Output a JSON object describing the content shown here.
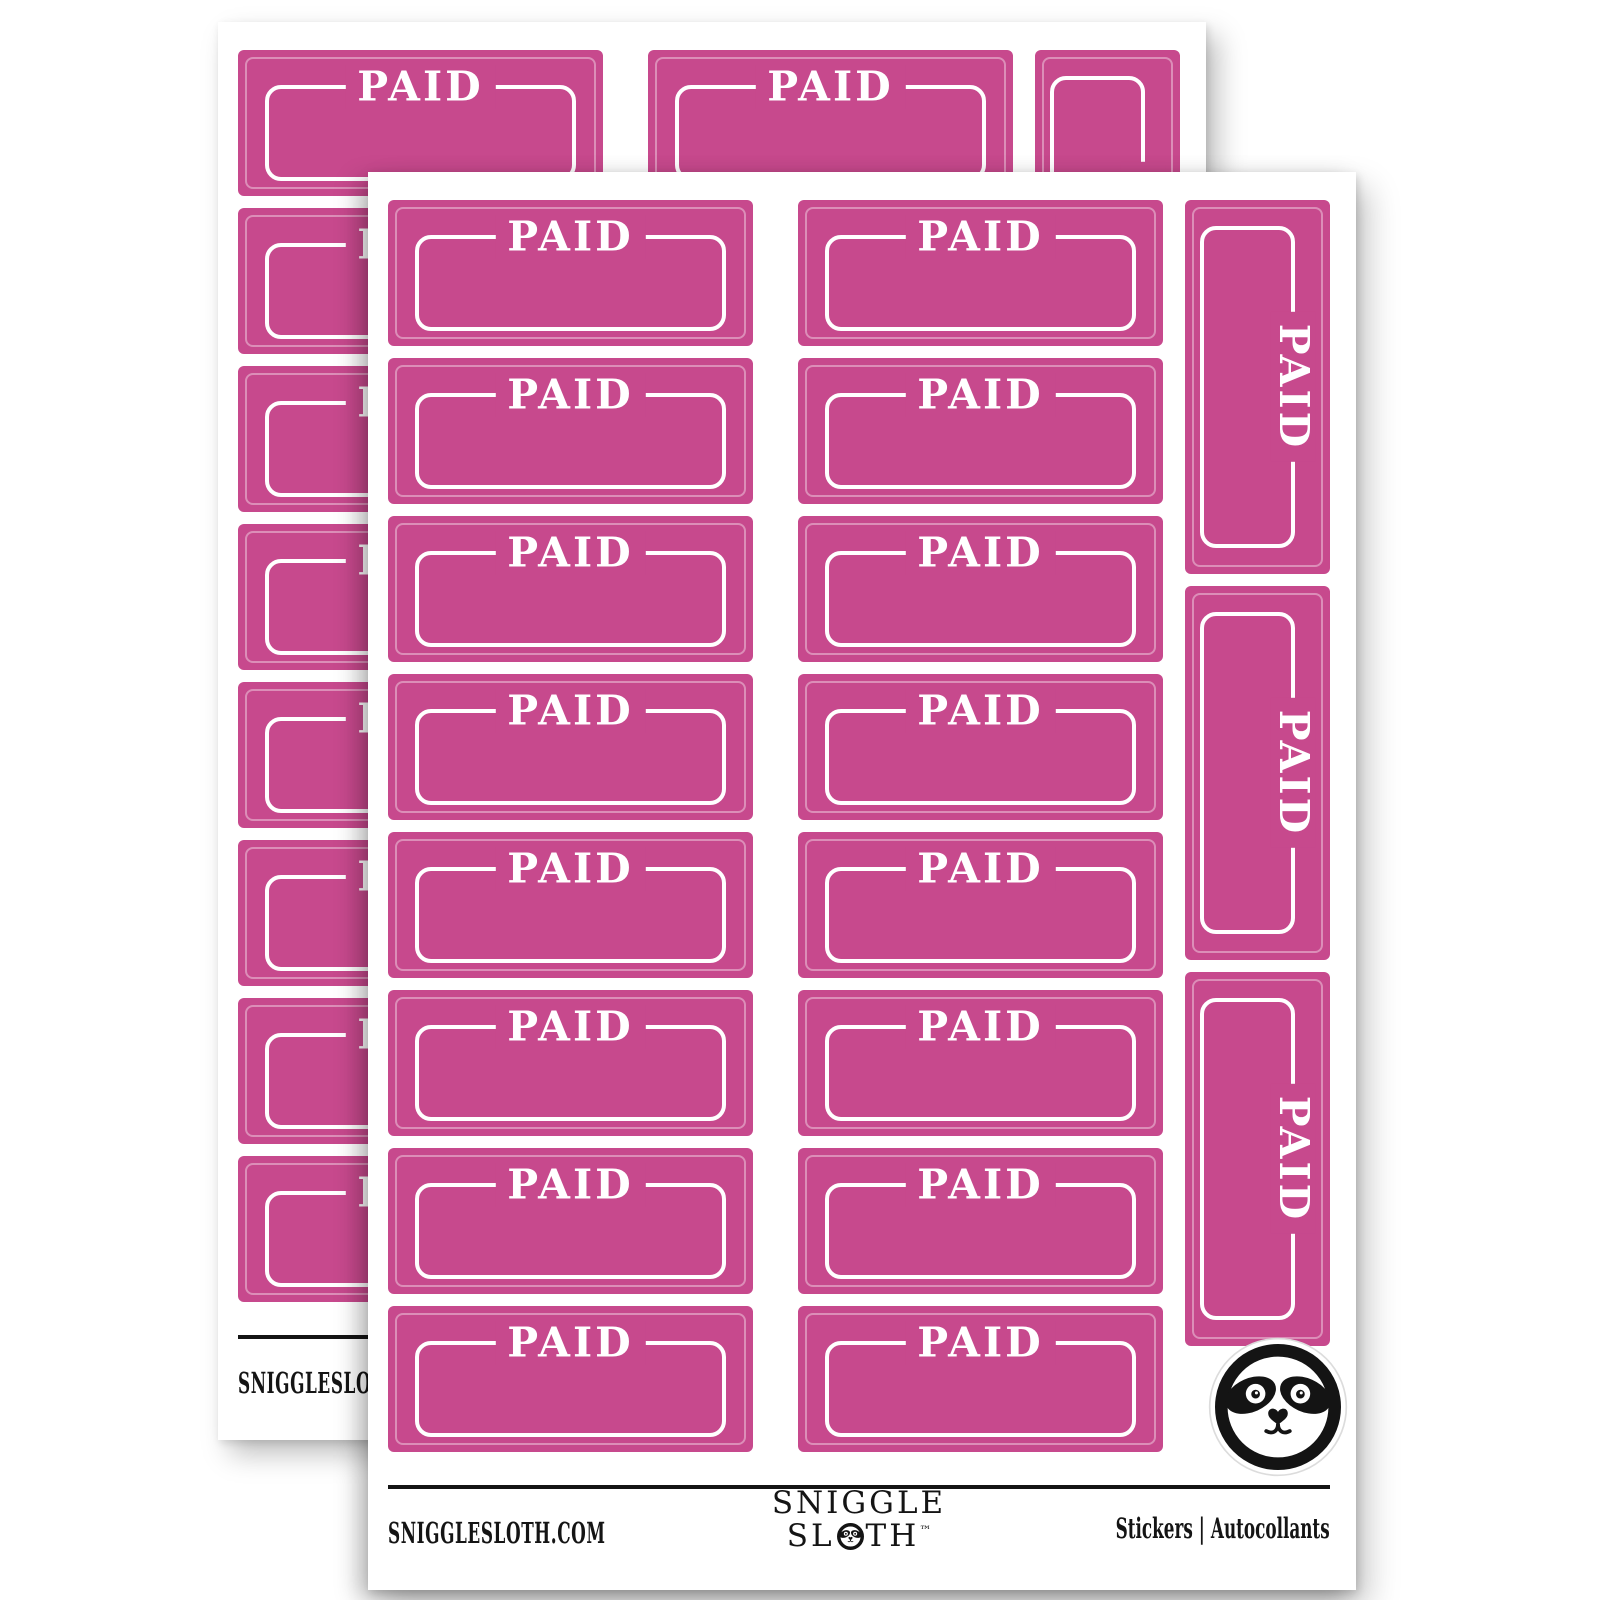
{
  "sticker": {
    "label": "PAID"
  },
  "layout": {
    "sheets": 2,
    "horizontal_columns": 2,
    "rows_per_column": 8,
    "vertical_stickers": 3
  },
  "colors": {
    "sticker_pink": "#C7498D",
    "die_cut_line": "rgba(255,255,255,0.38)",
    "frame_white": "#FFFFFF",
    "ink_black": "#141414",
    "sheet_white": "#FFFFFF"
  },
  "footer": {
    "website": "SNIGGLESLOTH.COM",
    "brand_line1": "SNIGGLE",
    "brand_line2_pre": "SL",
    "brand_line2_post": "TH",
    "trademark": "™",
    "type_en": "Stickers",
    "type_separator": "|",
    "type_fr": "Autocollants"
  },
  "icons": {
    "badge": "sloth-face-icon"
  }
}
